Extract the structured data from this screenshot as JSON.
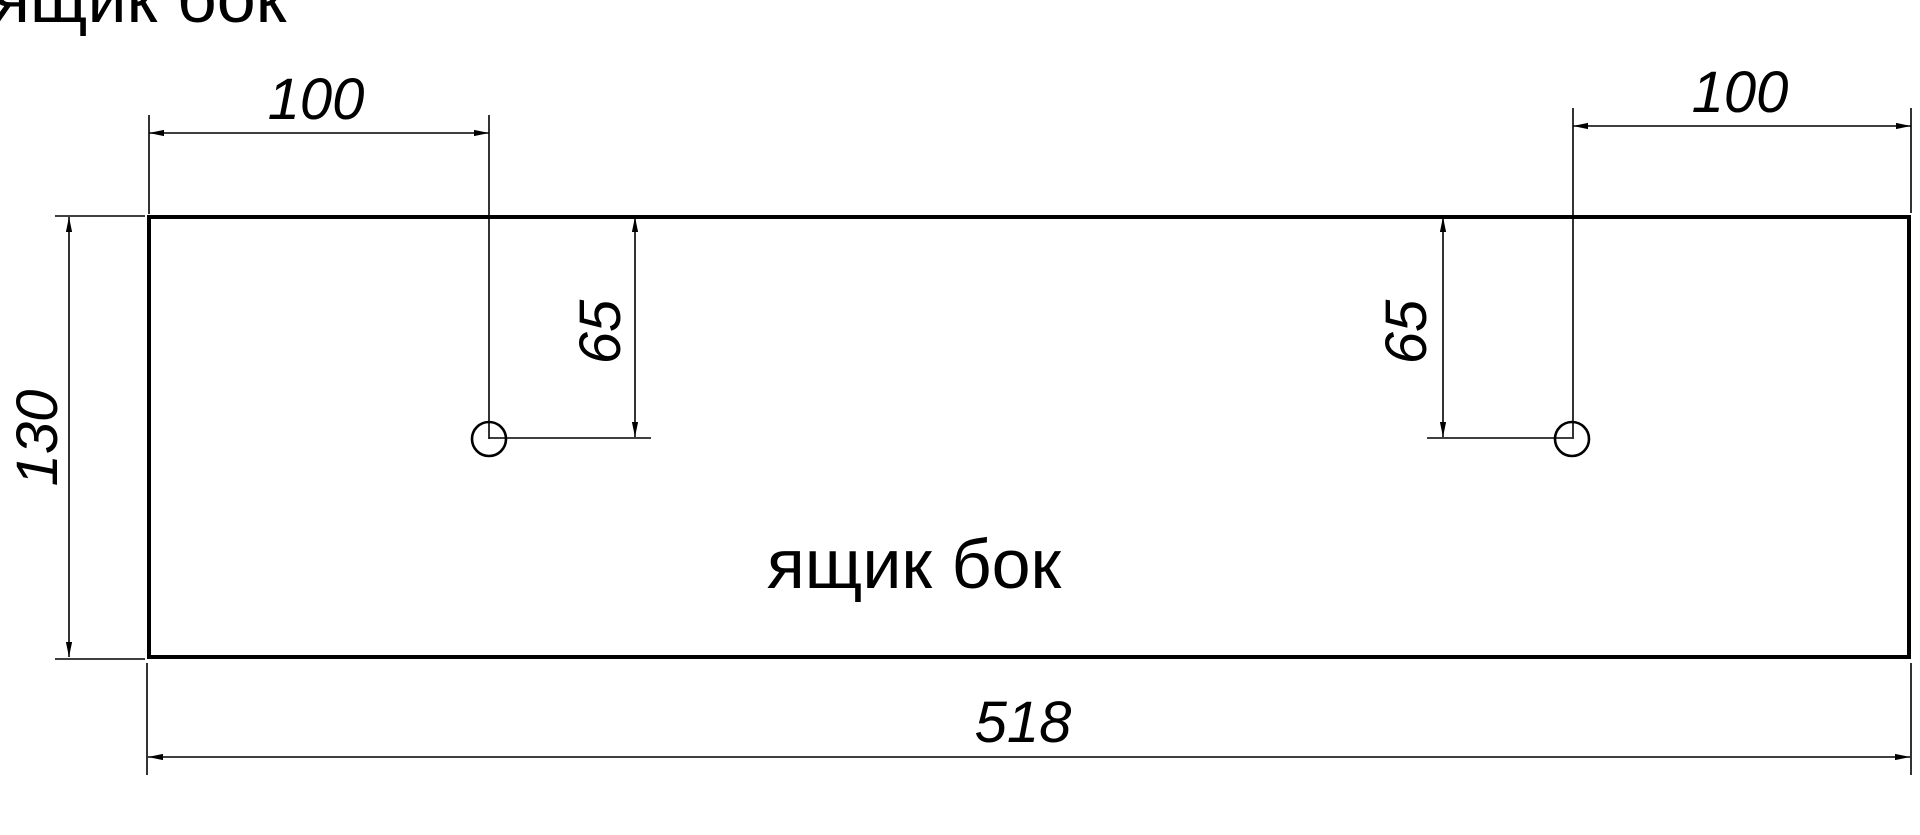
{
  "drawing": {
    "title": "ящик бок",
    "part_label": "ящик бок",
    "dim_values": {
      "hole_offset_left": "100",
      "hole_offset_right": "100",
      "hole_depth_left": "65",
      "hole_depth_right": "65",
      "panel_height": "130",
      "panel_width": "518"
    },
    "colors": {
      "line": "#000000",
      "background": "#ffffff"
    }
  }
}
